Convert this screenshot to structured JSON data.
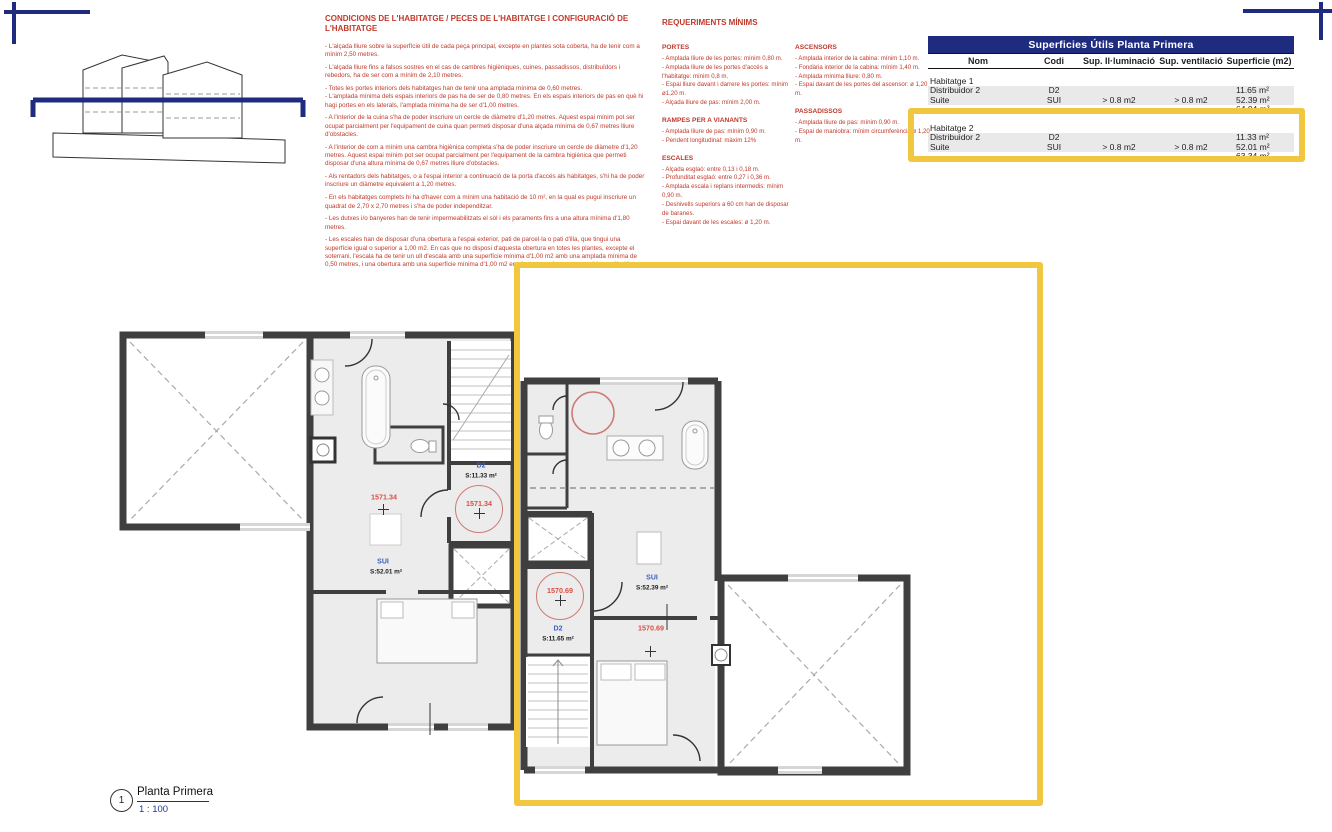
{
  "colors": {
    "accent_navy": "#1E2B7F",
    "highlight_yellow": "#F0C73E",
    "regulation_red": "#C0392B",
    "room_code_blue": "#3A5FBF",
    "marker_red": "#D94F43"
  },
  "conditions": {
    "title": "CONDICIONS DE L'HABITATGE / PECES DE L'HABITATGE I CONFIGURACIÓ DE L'HABITATGE",
    "bullets": [
      "- L'alçada lliure sobre la superfície útil de cada peça principal, excepte en plantes sota coberta, ha de tenir com a mínim 2,50 metres.",
      "- L'alçada lliure fins a falsos sostres en el cas de cambres higièniques, cuines, passadissos, distribuïdors i rebedors, ha de ser com a mínim de 2,10 metres.",
      "- Totes les portes interiors dels habitatges han de tenir una amplada mínima de 0,60 metres.",
      "- L'amplada mínima dels espais interiors de pas ha de ser de 0,80 metres. En els espais interiors de pas en què hi hagi portes en els laterals, l'amplada mínima ha de ser d'1,00 metres.",
      "- A l'interior de la cuina s'ha de poder inscriure un cercle de diàmetre d'1,20 metres. Aquest espai mínim pot ser ocupat parcialment per l'equipament de cuina quan permeti disposar d'una alçada mínima de 0,67 metres lliure d'obstacles.",
      "- A l'interior de com a mínim una cambra higiènica completa s'ha de poder inscriure un cercle de diàmetre d'1,20 metres. Aquest espai mínim pot ser ocupat parcialment per l'equipament de la cambra higiènica que permeti disposar d'una altura mínima de 0,67 metres lliure d'obstacles.",
      "- Als rentadors dels habitatges, o a l'espai interior a continuació de la porta d'accés als habitatges, s'hi ha de poder inscriure un diàmetre equivalent a 1,20 metres.",
      "- En els habitatges complets hi ha d'haver com a mínim una habitació de 10 m², en la qual es pugui inscriure un quadrat de 2,70 x 2,70 metres i s'ha de poder independitzar.",
      "- Les dutxes i/o banyeres han de tenir impermeabilitzats el sòl i els paraments fins a una altura mínima d'1,80 metres.",
      "- Les escales han de disposar d'una obertura a l'espai exterior, pati de parcel·la o pati d'illa, que tingui una superfície igual o superior a 1,00 m2. En cas que no disposi d'aquesta obertura en totes les plantes, excepte el soterrani, l'escala ha de tenir un ull d'escala amb una superfície mínima d'1,00 m2 amb una amplada mínima de 0,50 metres, i una obertura amb una superfície mínima d'1,00 m2 en planta superior que permeti la ventilació."
    ]
  },
  "requirements": {
    "title": "REQUERIMENTS MÍNIMS",
    "portes": {
      "heading": "PORTES",
      "items": [
        "- Amplada lliure de les portes: mínim 0,80 m.",
        "- Amplada lliure de les portes d'accés a l'habitatge: mínim 0,8 m.",
        "- Espai lliure davant i darrere les portes: mínim ø1,20 m.",
        "- Alçada lliure de pas: mínim 2,00 m."
      ]
    },
    "rampes": {
      "heading": "RAMPES PER A VIANANTS",
      "items": [
        "- Amplada lliure de pas: mínim 0,90 m.",
        "- Pendent longitudinal: màxim 12%"
      ]
    },
    "escales": {
      "heading": "ESCALES",
      "items": [
        "- Alçada esglaó: entre 0,13 i 0,18 m.",
        "- Profunditat esglaó: entre 0,27 i 0,36 m.",
        "- Amplada escala i replans intermedis: mínim 0,90 m.",
        "- Desnivells superiors a 60 cm han de disposar de baranes.",
        "- Espai davant de les escales: ø 1,20 m."
      ]
    },
    "ascensors": {
      "heading": "ASCENSORS",
      "items": [
        "- Amplada interior de la cabina: mínim 1,10 m.",
        "- Fondària interior de la cabina: mínim 1,40 m.",
        "- Amplada mínima lliure: 0,80 m.",
        "- Espai davant de les portes del ascensor: ø 1,20 m."
      ]
    },
    "passadissos": {
      "heading": "PASSADISSOS",
      "items": [
        "- Amplada lliure de pas: mínim 0,90 m.",
        "- Espai de maniobra: mínim circumferència ø 1,20 m."
      ]
    }
  },
  "table": {
    "title": "Superficies Útils Planta Primera",
    "columns": [
      "Nom",
      "Codi",
      "Sup. Il·luminació",
      "Sup. ventilació",
      "Superficie (m2)"
    ],
    "groups": [
      {
        "name": "Habitatge 1",
        "rows": [
          {
            "nom": "Distribuidor 2",
            "codi": "D2",
            "illum": "",
            "vent": "",
            "sup": "11.65 m²"
          },
          {
            "nom": "Suite",
            "codi": "SUI",
            "illum": "> 0.8 m2",
            "vent": "> 0.8 m2",
            "sup": "52.39 m²"
          }
        ],
        "total": "64.04 m²"
      },
      {
        "name": "Habitatge 2",
        "rows": [
          {
            "nom": "Distribuidor 2",
            "codi": "D2",
            "illum": "",
            "vent": "",
            "sup": "11.33 m²"
          },
          {
            "nom": "Suite",
            "codi": "SUI",
            "illum": "> 0.8 m2",
            "vent": "> 0.8 m2",
            "sup": "52.01 m²"
          }
        ],
        "total": "63.34 m²"
      }
    ]
  },
  "plan": {
    "unit1": {
      "d2_code": "D2",
      "d2_area": "S:11.33 m²",
      "sui_code": "SUI",
      "sui_area": "S:52.01 m²",
      "marker": "1571.34",
      "circle_marker": "1571.34"
    },
    "unit2": {
      "sui_code": "SUI",
      "sui_area": "S:52.39 m²",
      "d2_code": "D2",
      "d2_area": "S:11.65 m²",
      "marker": "1570.69",
      "circle_marker": "1570.69"
    },
    "view_title": {
      "number": "1",
      "name": "Planta Primera",
      "scale": "1 : 100"
    }
  }
}
